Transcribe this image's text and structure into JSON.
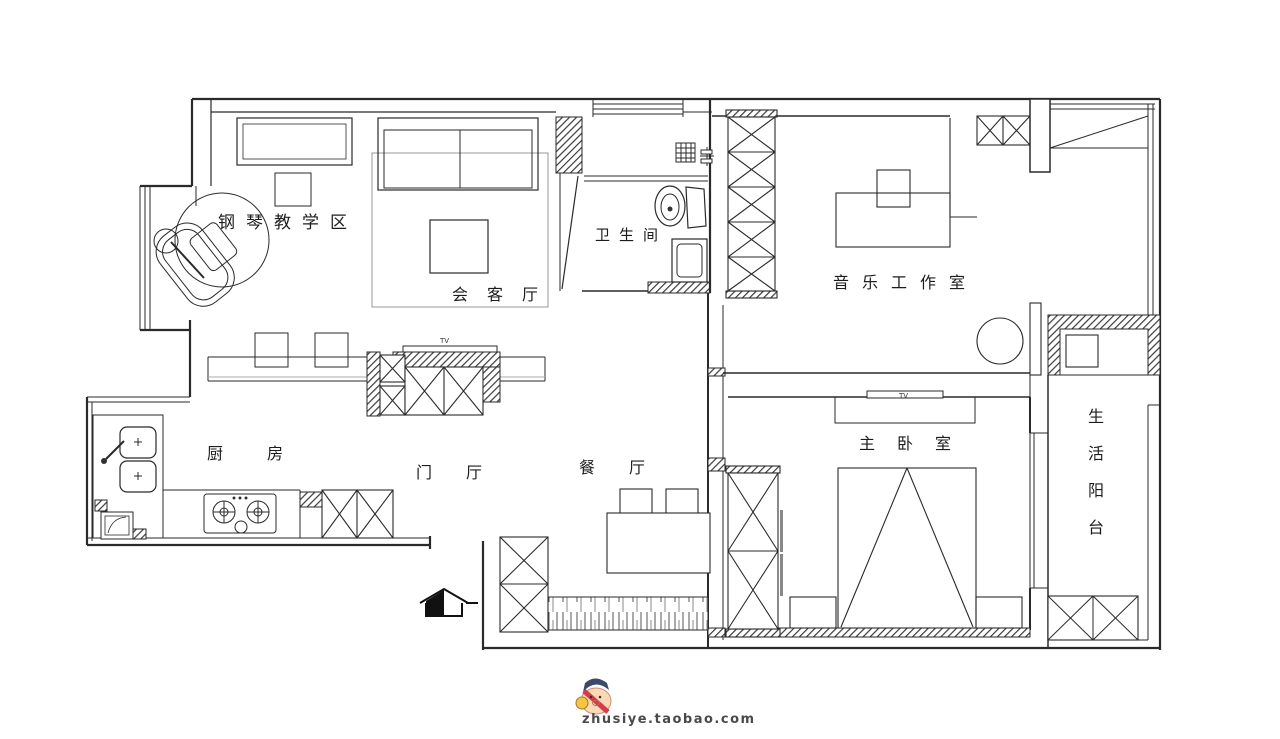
{
  "canvas": {
    "width": 1280,
    "height": 739,
    "background": "#ffffff",
    "line_color": "#2a2a2a"
  },
  "rooms": {
    "piano_area": {
      "label": "钢琴教学区"
    },
    "reception": {
      "label": "会客厅"
    },
    "bathroom": {
      "label": "卫生间"
    },
    "music_studio": {
      "label": "音乐工作室"
    },
    "kitchen": {
      "label": "厨房"
    },
    "foyer": {
      "label": "门厅"
    },
    "dining": {
      "label": "餐厅"
    },
    "master_bedroom": {
      "label": "主卧室"
    },
    "balcony": {
      "label": "生活阳台"
    }
  },
  "furniture_labels": {
    "tv_foyer": "TV",
    "tv_bedroom": "TV"
  },
  "watermark": {
    "text": "zhusiye.taobao.com"
  }
}
